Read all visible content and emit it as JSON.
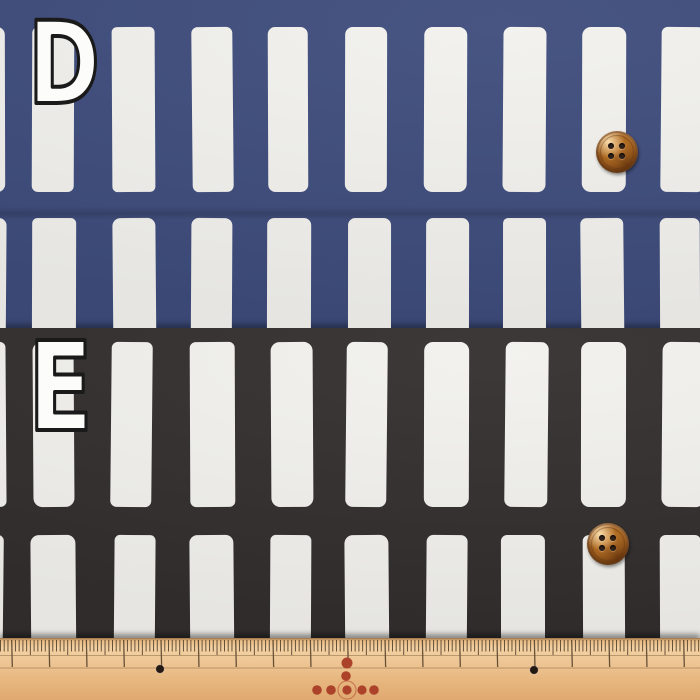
{
  "swatches": [
    {
      "label": "D",
      "fabric_color": "#3e4c7c",
      "stripe_color": "#f2f1ed",
      "button_color": "#a96a33"
    },
    {
      "label": "E",
      "fabric_color": "#322e2e",
      "stripe_color": "#f2f1ed",
      "button_color": "#a96a33"
    }
  ],
  "labels": {
    "fill": "#fcfcfb",
    "outline": "#1a1a1a"
  },
  "ruler": {
    "wood_color": "#eec493",
    "tick_color": "#4f3d27",
    "line_color": "#6b4f2e",
    "red_dot_color": "#ad422b",
    "hole_color": "#241813"
  }
}
